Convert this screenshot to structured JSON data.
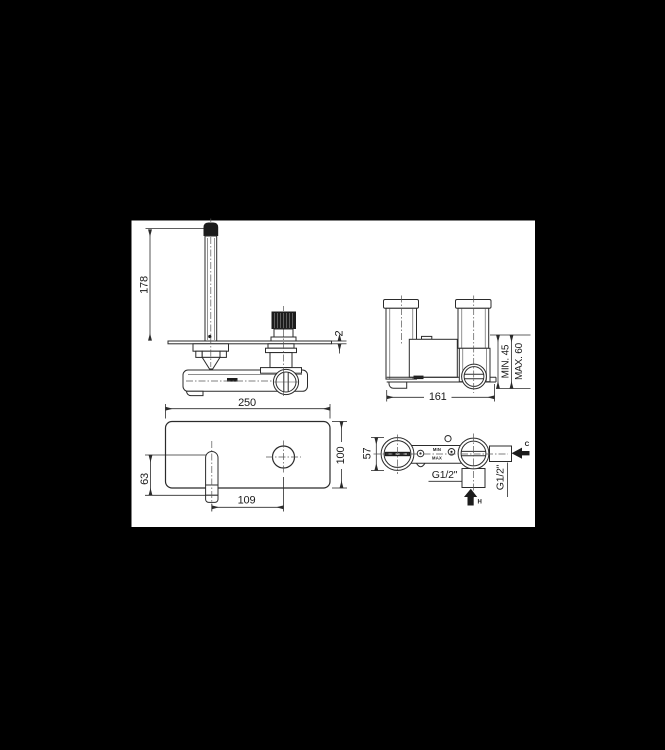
{
  "drawing": {
    "colors": {
      "canvas": "#000000",
      "paper": "#ffffff",
      "ink": "#2b2b2b"
    },
    "views": {
      "side": {
        "spout_height": "178",
        "plate_thickness": "2"
      },
      "rear": {
        "body_width": "161",
        "min_depth": "MIN. 45",
        "max_depth": "MAX. 60"
      },
      "front": {
        "plate_width": "250",
        "plate_height": "100",
        "spout_drop": "63",
        "spout_to_handle": "109"
      },
      "top": {
        "body_depth": "57",
        "cold_thread": "G1/2\"",
        "hot_thread": "G1/2\"",
        "cold_label": "C",
        "hot_label": "H",
        "min_label": "MIN",
        "max_label": "MAX"
      }
    }
  }
}
